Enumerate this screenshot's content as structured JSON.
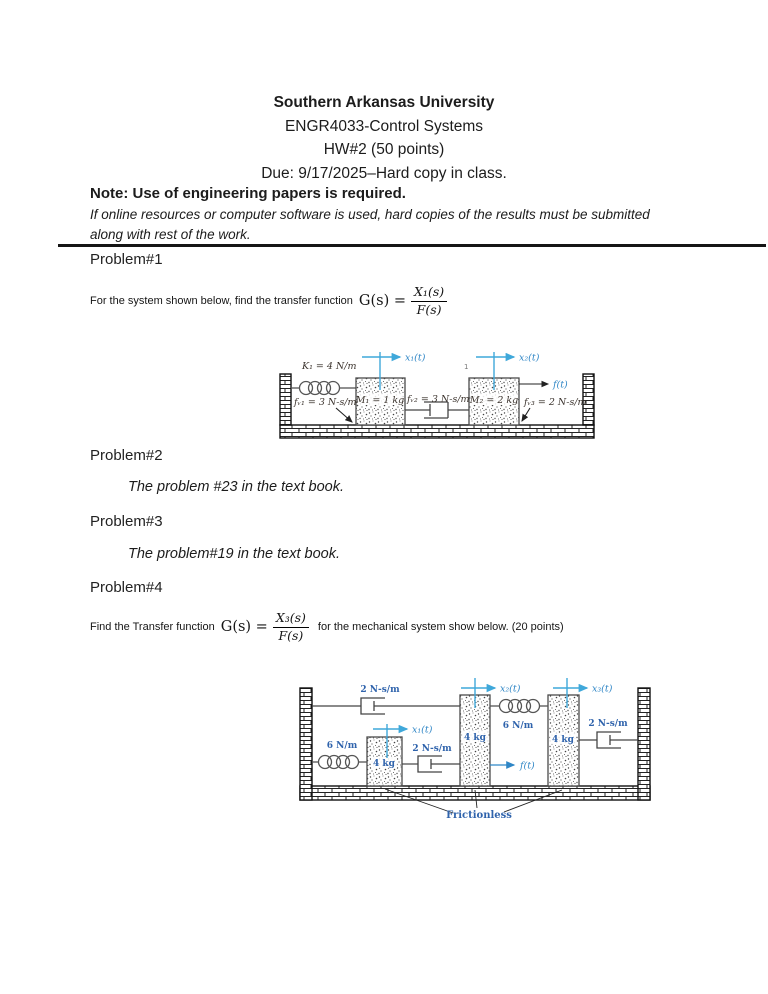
{
  "colors": {
    "text": "#1c1c1c",
    "accent_blue": "#2f86c6",
    "crosshair_blue": "#3fa8da",
    "component_blue": "#2f63ac",
    "diagram_dark": "#3c342e"
  },
  "header": {
    "line1": "Southern Arkansas University",
    "line2": "ENGR4033-Control Systems",
    "line3": "HW#2 (50 points)",
    "line4": "Due: 9/17/2025–Hard copy in class.",
    "note": "Note: Use of engineering papers is required.",
    "note_italic_line1": "If online resources or computer software is used, hard copies of the results must be submitted",
    "note_italic_line2": "along with rest of the work."
  },
  "problem1": {
    "heading": "Problem#1",
    "prompt": "For the system shown below, find the transfer function",
    "gs": "G(s) =",
    "frac_num": "X₁(s)",
    "frac_den": "F(s)"
  },
  "problem2": {
    "heading": "Problem#2",
    "body": "The problem #23 in the text book."
  },
  "problem3": {
    "heading": "Problem#3",
    "body": "The problem#19 in the text book."
  },
  "problem4": {
    "heading": "Problem#4",
    "prompt": "Find the Transfer function",
    "gs": "G(s) =",
    "frac_num": "X₃(s)",
    "frac_den": "F(s)",
    "suffix": "for the mechanical system show below. (20 points)"
  },
  "diagram1": {
    "spring_k1": "K₁ = 4 N/m",
    "x1": "x₁(t)",
    "x2": "x₂(t)",
    "f": "f(t)",
    "mass1": "M₁ = 1 kg",
    "mass2": "M₂ = 2 kg",
    "fv1": "fᵥ₁ = 3 N-s/m",
    "fv2": "fᵥ₂ = 3 N-s/m",
    "fv3": "fᵥ₃ = 2 N-s/m",
    "stray_mark": "1"
  },
  "diagram2": {
    "damper_top": "2 N-s/m",
    "damper_mid": "2 N-s/m",
    "damper_right": "2 N-s/m",
    "spring_left": "6 N/m",
    "spring_mid": "6 N/m",
    "mass1": "4 kg",
    "mass2": "4 kg",
    "mass3": "4 kg",
    "x1": "x₁(t)",
    "x2": "x₂(t)",
    "x3": "x₃(t)",
    "f": "f(t)",
    "frictionless": "Frictionless"
  }
}
